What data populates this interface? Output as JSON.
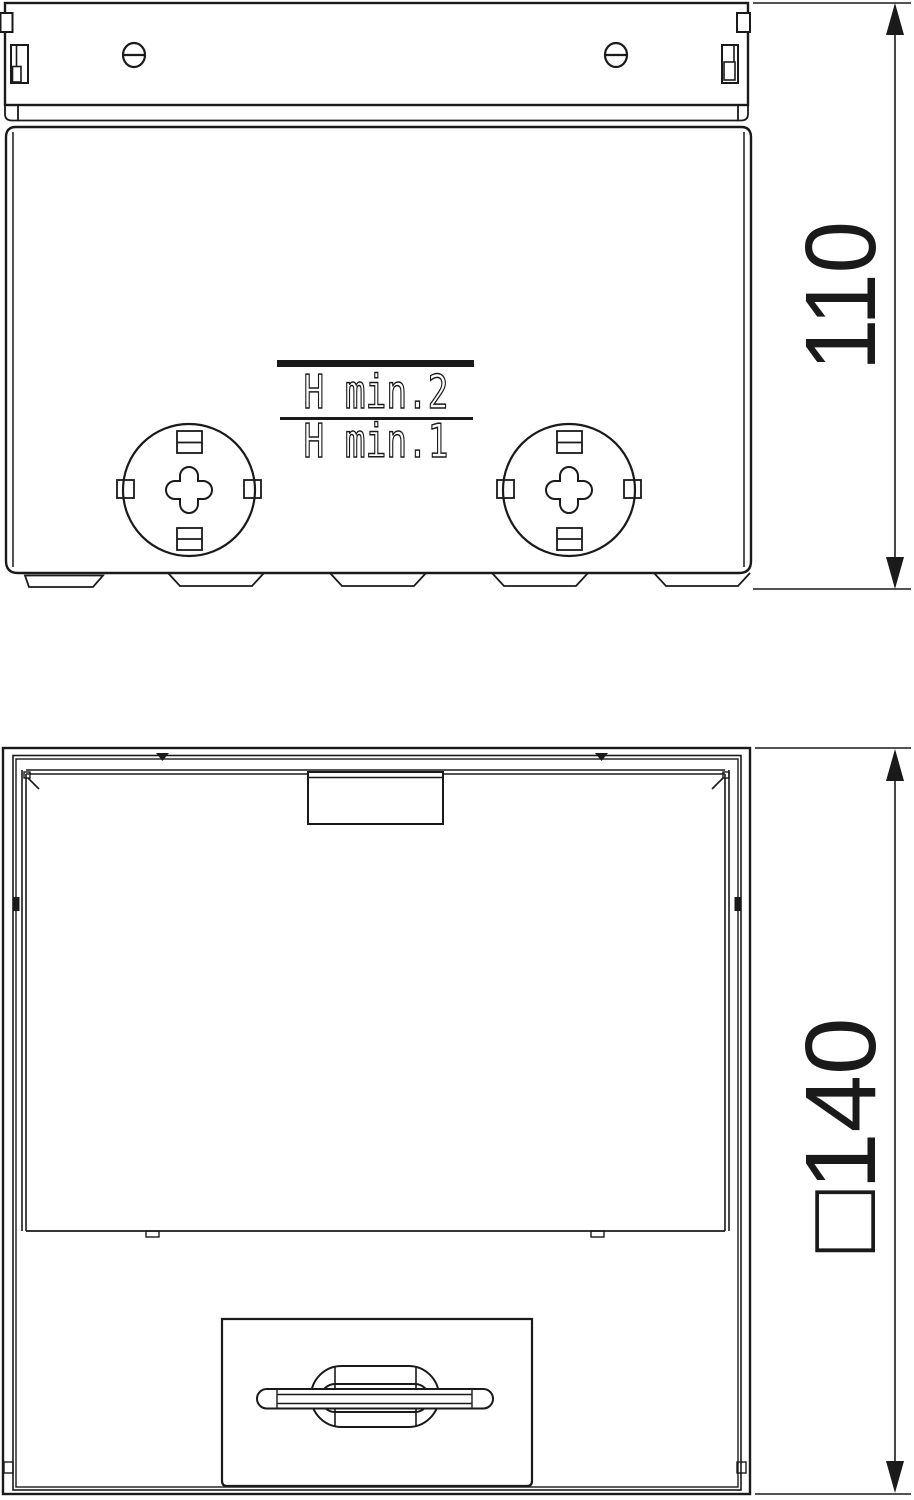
{
  "drawing": {
    "background": "#ffffff",
    "line_color": "#1a1a1a",
    "side_view": {
      "engraving_line1": "H min.2",
      "engraving_line2": "H min.1",
      "height_dimension": "110"
    },
    "plan_view": {
      "width_dimension": "□140"
    }
  }
}
